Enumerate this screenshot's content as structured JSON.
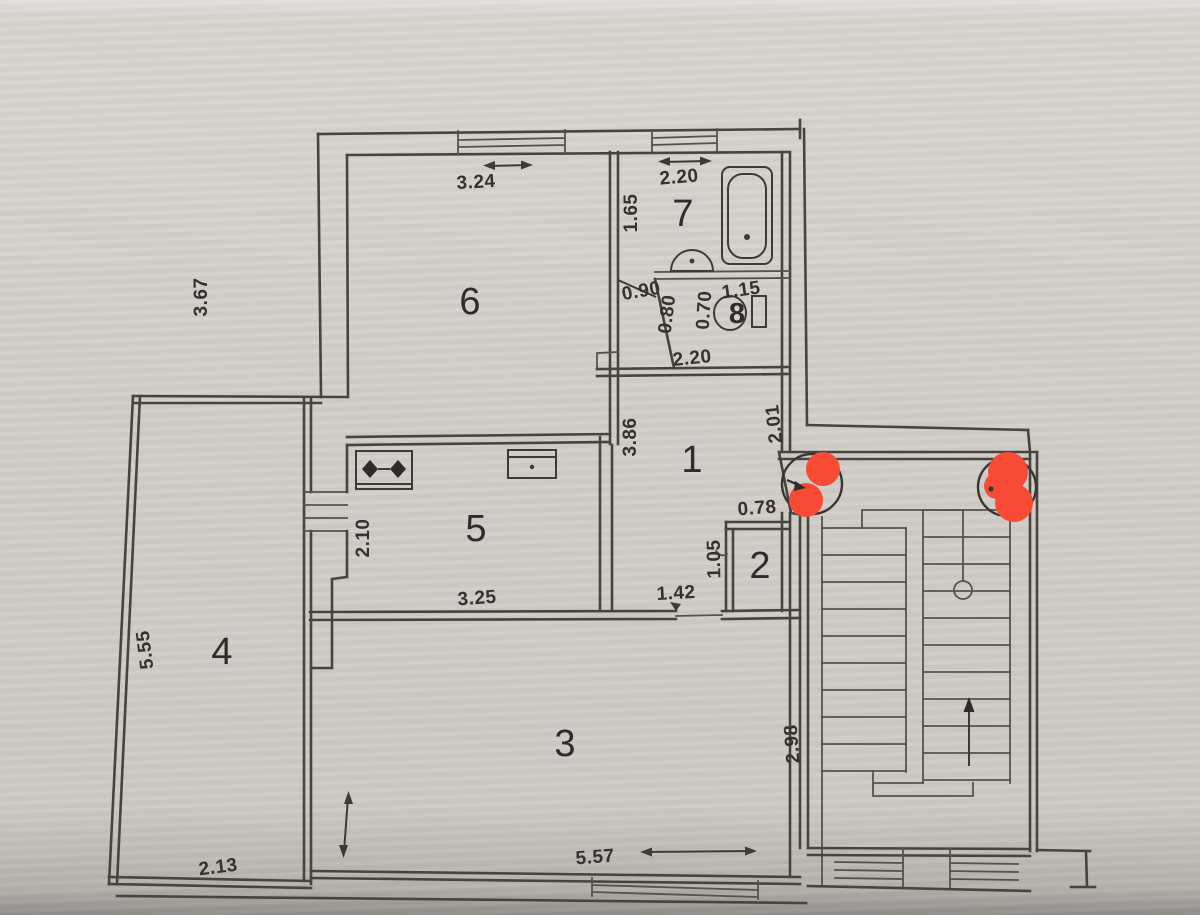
{
  "floor_plan": {
    "room_labels": {
      "r1": "1",
      "r2": "2",
      "r3": "3",
      "r4": "4",
      "r5": "5",
      "r6": "6",
      "r7": "7",
      "r8": "8"
    },
    "dimensions": {
      "room6_width": "3.24",
      "room6_depth": "3.67",
      "bath_width": "2.20",
      "bath_depth": "1.65",
      "bath_door": "0.90",
      "wc_left": "0.80",
      "wc_right": "0.70",
      "wc_width": "1.15",
      "wc_bottom": "2.20",
      "hall_depth": "3.86",
      "entry_wall": "2.01",
      "closet_width": "0.78",
      "closet_depth": "1.05",
      "hall_opening": "1.42",
      "kitchen_depth": "2.10",
      "kitchen_width": "3.25",
      "balcony_depth": "5.55",
      "balcony_width": "2.13",
      "living_width": "5.57",
      "living_depth": "2.98"
    },
    "colors": {
      "marker_red": "#f84b35",
      "ink": "#47443e",
      "paper": "#d2cfca"
    }
  }
}
